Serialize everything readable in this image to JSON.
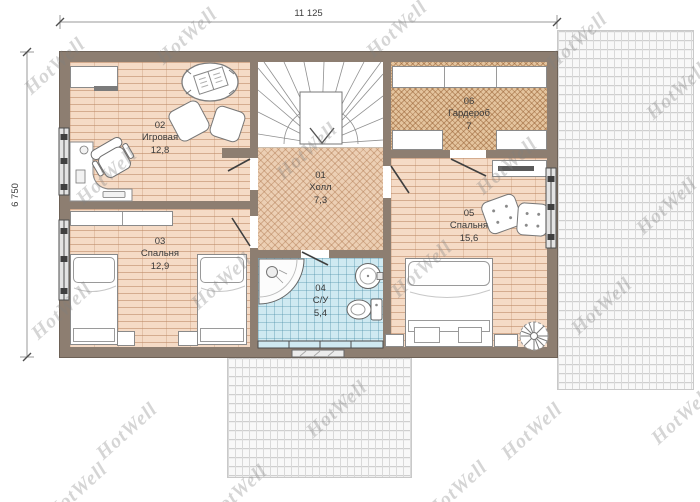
{
  "watermark": {
    "text": "HotWell"
  },
  "dimensions": {
    "width_label": "11 125",
    "height_label": "6 750"
  },
  "rooms": [
    {
      "number": "01",
      "name": "Холл",
      "area": "7,3"
    },
    {
      "number": "02",
      "name": "Игровая",
      "area": "12,8"
    },
    {
      "number": "03",
      "name": "Спальня",
      "area": "12,9"
    },
    {
      "number": "04",
      "name": "С/У",
      "area": "5,4"
    },
    {
      "number": "05",
      "name": "Спальня",
      "area": "15,6"
    },
    {
      "number": "06",
      "name": "Гардероб",
      "area": "7"
    }
  ],
  "colors": {
    "wall": "#8d7e71",
    "floor_wood": "#f5dbc6",
    "floor_hall": "#eccfb4",
    "floor_wardrobe": "#e4c49e",
    "floor_bath": "#cfe9f1",
    "roof": "#f0f0f0",
    "window_frame": "#4c4c4c"
  }
}
